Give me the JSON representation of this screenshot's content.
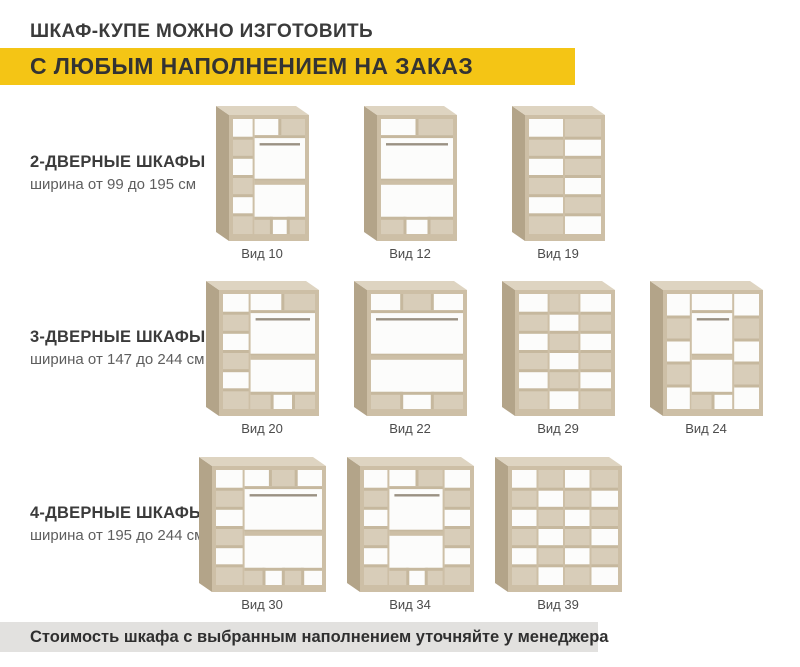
{
  "header": {
    "title": "ШКАФ-КУПЕ МОЖНО ИЗГОТОВИТЬ",
    "subtitle": "С ЛЮБЫМ НАПОЛНЕНИЕМ НА ЗАКАЗ",
    "highlight_color": "#f4c515"
  },
  "rows": [
    {
      "heading": "2-ДВЕРНЫЕ ШКАФЫ",
      "subheading": "ширина от 99 до 195 см",
      "cabinets": [
        {
          "label": "Вид 10",
          "columns": [
            {
              "type": "shelves",
              "width": 30,
              "cells": 6
            },
            {
              "type": "hanging",
              "width": 70,
              "top_cubbies": 2,
              "bottom_cubbies": 3
            }
          ]
        },
        {
          "label": "Вид 12",
          "columns": [
            {
              "type": "hanging",
              "width": 100,
              "top_cubbies": 2,
              "bottom_cubbies": 3
            }
          ]
        },
        {
          "label": "Вид 19",
          "columns": [
            {
              "type": "shelves",
              "width": 50,
              "cells": 6
            },
            {
              "type": "shelves",
              "width": 50,
              "cells": 6
            }
          ]
        }
      ]
    },
    {
      "heading": "3-ДВЕРНЫЕ ШКАФЫ",
      "subheading": "ширина от 147 до 244 см",
      "cabinets": [
        {
          "label": "Вид 20",
          "columns": [
            {
              "type": "shelves",
              "width": 30,
              "cells": 6
            },
            {
              "type": "hanging",
              "width": 70,
              "top_cubbies": 2,
              "bottom_cubbies": 3
            }
          ]
        },
        {
          "label": "Вид 22",
          "columns": [
            {
              "type": "hanging",
              "width": 100,
              "top_cubbies": 3,
              "bottom_cubbies": 3
            }
          ]
        },
        {
          "label": "Вид 29",
          "columns": [
            {
              "type": "shelves",
              "width": 33.3,
              "cells": 6
            },
            {
              "type": "shelves",
              "width": 33.4,
              "cells": 6
            },
            {
              "type": "shelves",
              "width": 33.3,
              "cells": 6
            }
          ]
        },
        {
          "label": "Вид 24",
          "columns": [
            {
              "type": "shelves",
              "width": 27,
              "cells": 5
            },
            {
              "type": "hanging",
              "width": 46,
              "top_cubbies": 1,
              "bottom_cubbies": 2
            },
            {
              "type": "shelves",
              "width": 27,
              "cells": 5
            }
          ]
        }
      ]
    },
    {
      "heading": "4-ДВЕРНЫЕ ШКАФЫ",
      "subheading": "ширина от 195 до 244 см",
      "cabinets": [
        {
          "label": "Вид 30",
          "columns": [
            {
              "type": "shelves",
              "width": 27,
              "cells": 6
            },
            {
              "type": "hanging",
              "width": 73,
              "top_cubbies": 3,
              "bottom_cubbies": 4
            }
          ]
        },
        {
          "label": "Вид 34",
          "columns": [
            {
              "type": "shelves",
              "width": 24,
              "cells": 6
            },
            {
              "type": "hanging",
              "width": 52,
              "top_cubbies": 2,
              "bottom_cubbies": 3
            },
            {
              "type": "shelves",
              "width": 24,
              "cells": 6
            }
          ]
        },
        {
          "label": "Вид 39",
          "columns": [
            {
              "type": "shelves",
              "width": 25,
              "cells": 6
            },
            {
              "type": "shelves",
              "width": 25,
              "cells": 6
            },
            {
              "type": "shelves",
              "width": 25,
              "cells": 6
            },
            {
              "type": "shelves",
              "width": 25,
              "cells": 6
            }
          ]
        }
      ]
    }
  ],
  "footer": {
    "text": "Стоимость шкафа с выбранным наполнением уточняйте у менеджера",
    "background_color": "#e2e1df"
  },
  "colors": {
    "wood_frame": "#cdbfa6",
    "wood_shelf": "#c6b89e",
    "wood_cell": "#d8cdb9",
    "wood_side": "#b3a489",
    "wood_top": "#ded4c1",
    "panel_white": "#fcfcfb",
    "rod": "#9a9183"
  }
}
